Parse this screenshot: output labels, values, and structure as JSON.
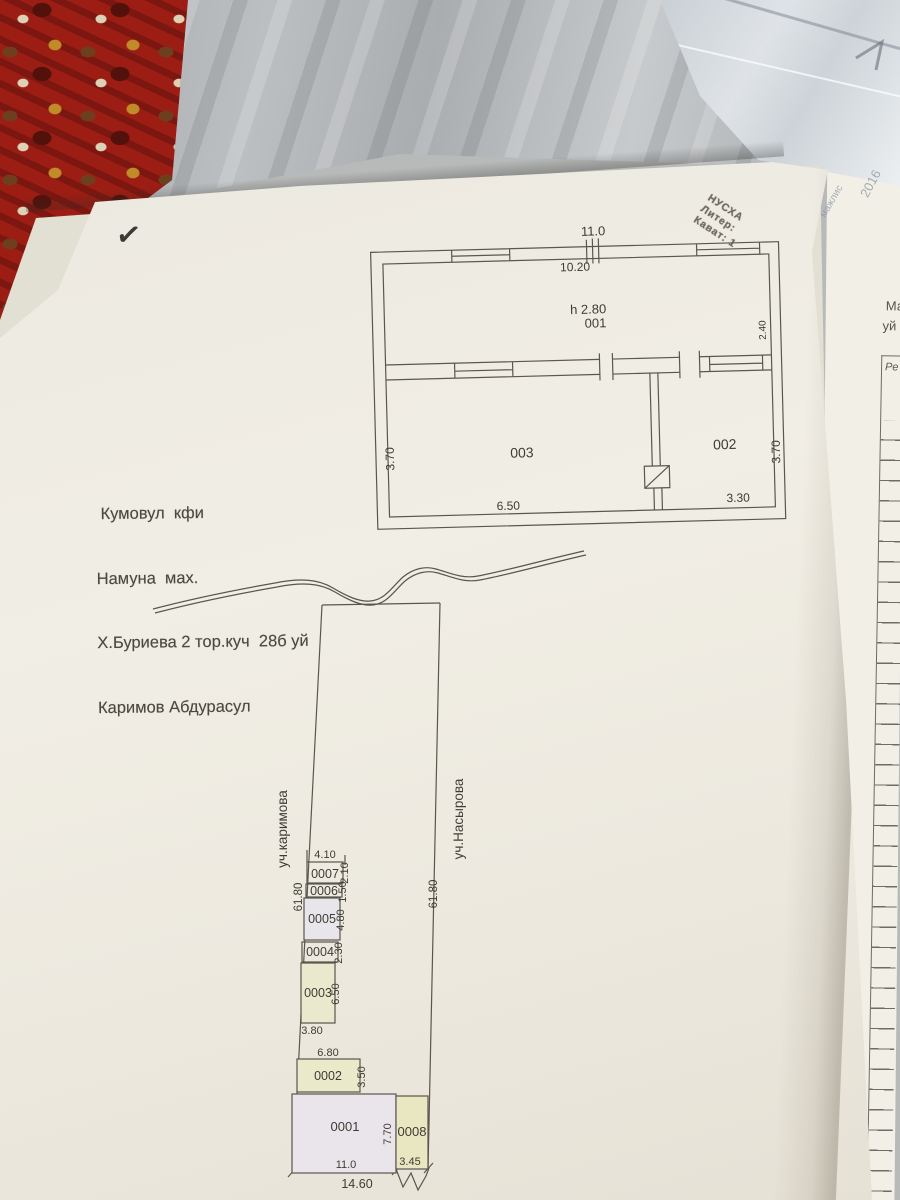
{
  "photo": {
    "checkmark": "✓"
  },
  "stamp": {
    "line1": "НУСХА",
    "line2": "Литер:",
    "line3": "Кават: 1"
  },
  "address_block": {
    "line1": " Кумовул  кфи",
    "line2": "Намуна  мах.",
    "line3": "Х.Буриева 2 тор.куч  28б уй",
    "line4": "Каримов Абдурасул"
  },
  "floor_plan": {
    "dim_width_total": "11.0",
    "dim_width_inner": "10.20",
    "room_001": {
      "height_note": "h 2.80",
      "label": "001",
      "dim_right": "2.40"
    },
    "room_003": {
      "label": "003",
      "dim_left": "3.70",
      "dim_bottom": "6.50"
    },
    "room_002": {
      "label": "002",
      "dim_right": "3.70",
      "dim_bottom": "3.30"
    }
  },
  "site_plan": {
    "street_left": "уч.каримова",
    "street_right": "уч.Насырова",
    "length_left": "61.80",
    "length_right": "61.80",
    "bottom_total": "14.60",
    "plots": [
      {
        "id": "0007",
        "dim_top": "4.10",
        "dim_right": "2.10"
      },
      {
        "id": "0006",
        "dim_right": "1.50"
      },
      {
        "id": "0005",
        "dim_right": "4.80"
      },
      {
        "id": "0004",
        "dim_right": "2.30"
      },
      {
        "id": "0003",
        "dim_right": "6.50",
        "dim_bottom": "3.80"
      },
      {
        "id": "0002",
        "dim_top": "6.80",
        "dim_right": "3.50"
      },
      {
        "id": "0001",
        "dim_bottom": "11.0",
        "dim_right": "7.70"
      },
      {
        "id": "0008",
        "dim_bottom": "3.45"
      }
    ]
  },
  "side_page": {
    "text_line1": "Ма",
    "text_line2": "уй",
    "table_header": "Ре"
  },
  "background_texts": {
    "faint1": "мажлис",
    "faint2": "2016",
    "faint3": "Тар"
  }
}
